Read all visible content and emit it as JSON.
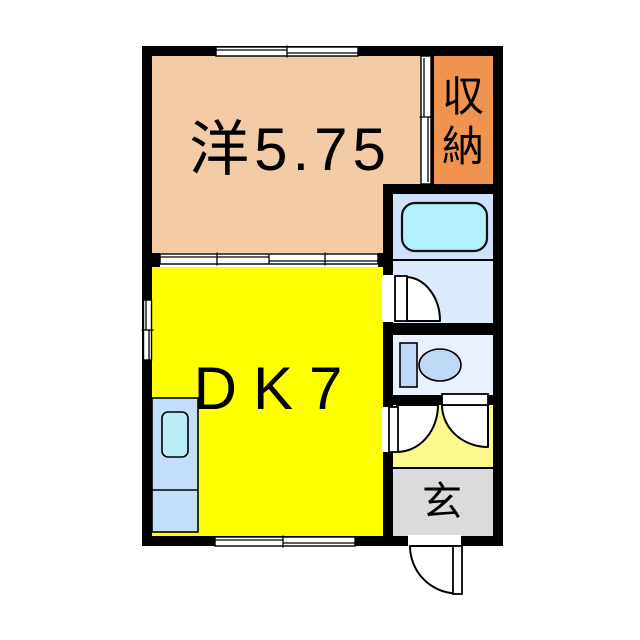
{
  "title": "apartment-floor-plan",
  "rooms": {
    "western": {
      "label": "洋5.75",
      "color": "#F3CCA6"
    },
    "storage": {
      "label": "収納",
      "color": "#F0934E"
    },
    "dk": {
      "label": "DK7",
      "color": "#FFFF00"
    },
    "entrance": {
      "label": "玄",
      "color": "#DBDBDB"
    },
    "bath": {
      "color": "#CEE2FA"
    },
    "washroom": {
      "color": "#DCEAFB"
    },
    "toilet": {
      "color": "#E8F1FC"
    },
    "hallway": {
      "color": "#FCFA8C"
    }
  },
  "fixtures": {
    "bathtub": {
      "name": "bathtub-icon",
      "color": "#B2F0FA"
    },
    "toilet": {
      "name": "toilet-icon",
      "color": "#BFD8F5"
    },
    "counter": {
      "name": "kitchen-counter",
      "color": "#C4DDF8"
    },
    "sink": {
      "name": "kitchen-sink-icon",
      "color": "#B9EDF6"
    }
  },
  "walls": {
    "color": "#000000"
  },
  "background": "#FFFFFF"
}
